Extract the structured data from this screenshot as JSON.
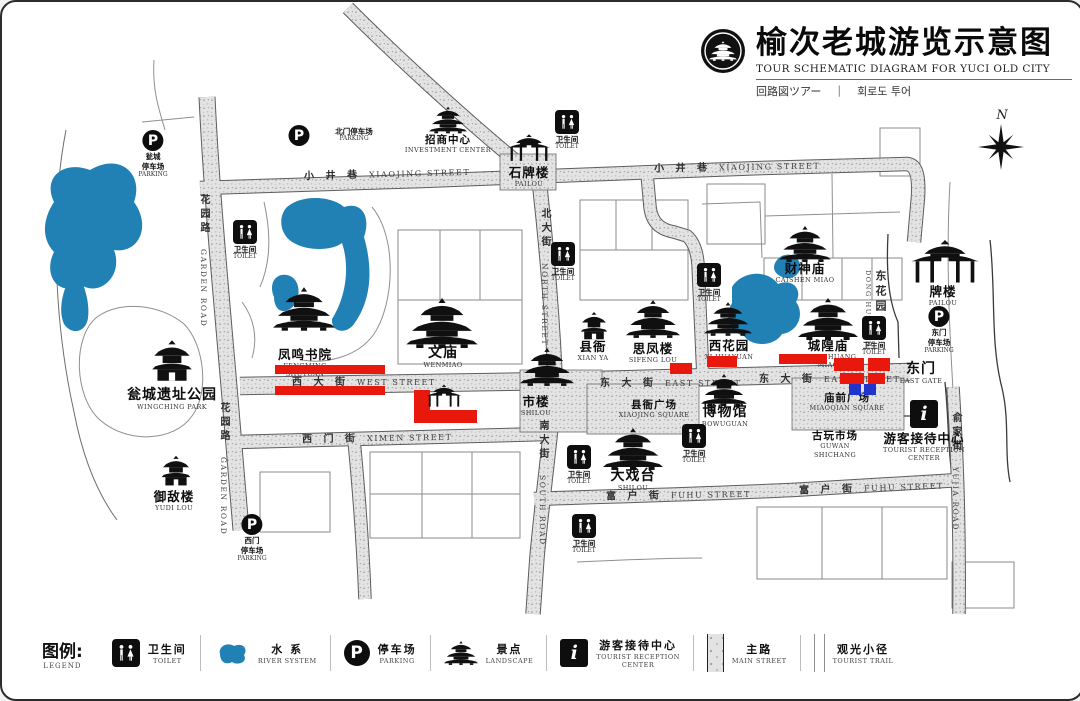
{
  "title": {
    "zh": "榆次老城游览示意图",
    "en": "TOUR SCHEMATIC DIAGRAM FOR YUCI OLD CITY",
    "ja": "回路図ツアー",
    "ko": "회로도 투어",
    "divider": "|"
  },
  "glyphs": {
    "parking": "P",
    "info": "i",
    "compass_north": "N"
  },
  "labels": {
    "toilet_zh": "卫生间",
    "toilet_en": "TOILET"
  },
  "parking": {
    "beimen": {
      "zh": "北门停车场",
      "en": "PARKING"
    },
    "wengcheng": {
      "zh1": "瓮城",
      "zh2": "停车场",
      "en": "PARKING"
    },
    "ximen": {
      "zh1": "西门",
      "zh2": "停车场",
      "en": "PARKING"
    },
    "dongmen": {
      "zh1": "东门",
      "zh2": "停车场",
      "en": "PARKING"
    }
  },
  "streets": {
    "xiaojing": {
      "zh": "小 井 巷",
      "en": "XIAOJING STREET"
    },
    "garden": {
      "zh": "花园路",
      "en": "GARDEN ROAD"
    },
    "north": {
      "zh": "北大街",
      "en": "NORTH STREET"
    },
    "south": {
      "zh": "南大街",
      "en": "SOUTH ROAD"
    },
    "west": {
      "zh": "西 大 街",
      "en": "WEST STREET"
    },
    "east": {
      "zh": "东 大 街",
      "en": "EAST STREET"
    },
    "ximen": {
      "zh": "西 门 街",
      "en": "XIMEN STREET"
    },
    "fuhu": {
      "zh": "富 户 街",
      "en": "FUHU STREET"
    },
    "yujia": {
      "zh": "俞家街",
      "en": "YUJIA ROAD"
    }
  },
  "sites": {
    "fengming": {
      "zh": "凤鸣书院",
      "en1": "FENGMING",
      "en2": "SHUYUAN"
    },
    "wingching": {
      "zh": "瓮城遗址公园",
      "en": "WINGCHING PARK"
    },
    "yudilou": {
      "zh": "御敌楼",
      "en": "YUDI LOU"
    },
    "shipailou": {
      "zh": "石牌楼",
      "en": "PAILOU"
    },
    "investment": {
      "zh": "招商中心",
      "en": "INVESTMENT CENTER"
    },
    "wenmiao": {
      "zh": "文庙",
      "en": "WENMIAO"
    },
    "xianya": {
      "zh": "县衙",
      "en": "XIAN YA"
    },
    "sifenglou": {
      "zh": "思凤楼",
      "en": "SIFENG LOU"
    },
    "xihuayuan": {
      "zh": "西花园",
      "en": "XI HUAYUAN"
    },
    "chenghuang": {
      "zh": "城隍庙",
      "en1": "CHENGHUANG",
      "en2": "MIAO"
    },
    "caishen": {
      "zh": "财神庙",
      "en": "CAISHEN MIAO"
    },
    "shilou": {
      "zh": "市楼",
      "en": "SHILOU"
    },
    "bowuguan": {
      "zh": "博物馆",
      "en": "BOWUGUAN"
    },
    "daxitai": {
      "zh": "大戏台",
      "en": "SHILOU"
    },
    "pailou_east": {
      "zh": "牌楼",
      "en": "PAILOU"
    },
    "dongmen": {
      "zh": "东门",
      "en": "EAST GATE"
    },
    "donghuayuan": {
      "zh": "东花园",
      "en": "DONG HUAYUAN"
    },
    "reception": {
      "zh": "游客接待中心",
      "en1": "TOURIST RECEPTION",
      "en2": "CENTER"
    },
    "guwan": {
      "zh": "古玩市场",
      "en1": "GUWAN",
      "en2": "SHICHANG"
    },
    "miaoqian": {
      "zh": "庙前广场",
      "en": "MIAOQIAN SQUARE"
    },
    "xianya_square": {
      "zh": "县衙广场",
      "en": "XIAOJING SQUARE"
    }
  },
  "legend": {
    "heading_zh": "图例:",
    "heading_en": "LEGEND",
    "items": [
      {
        "zh": "卫生间",
        "en": "TOILET"
      },
      {
        "zh": "水 系",
        "en": "RIVER SYSTEM"
      },
      {
        "zh": "停车场",
        "en": "PARKING"
      },
      {
        "zh": "景点",
        "en": "LANDSCAPE"
      },
      {
        "zh": "游客接待中心",
        "en1": "TOURIST RECEPTION",
        "en2": "CENTER"
      },
      {
        "zh": "主路",
        "en": "MAIN STREET"
      },
      {
        "zh": "观光小径",
        "en": "TOURIST TRAIL"
      }
    ]
  },
  "colors": {
    "water": "#2180b4",
    "highlight_red": "#e8190c",
    "highlight_blue": "#2233cc"
  }
}
